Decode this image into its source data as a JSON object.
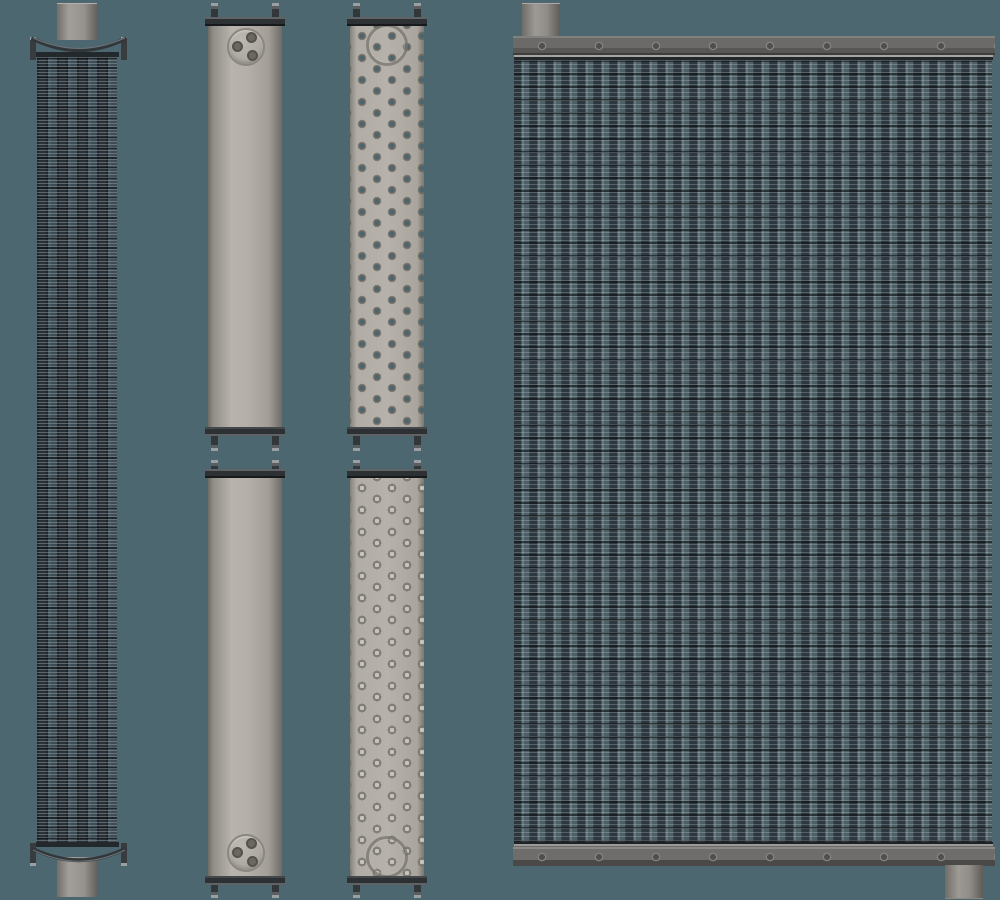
{
  "scene": {
    "background_color": "#4d6770",
    "parts": [
      {
        "id": "core-side-view",
        "label": "radiator core side view with end caps and pipe stubs"
      },
      {
        "id": "upper-tank",
        "label": "upper header tank with three-hole boss"
      },
      {
        "id": "upper-header-plate",
        "label": "upper header plate with staggered tube holes"
      },
      {
        "id": "lower-tank",
        "label": "lower header tank with three-hole boss"
      },
      {
        "id": "lower-header-plate",
        "label": "lower header plate with staggered tube holes"
      },
      {
        "id": "radiator-assembly",
        "label": "assembled radiator core with top and bottom headers and pipes"
      }
    ]
  },
  "colors": {
    "background": "#4d6770",
    "tank_light_gray": "#b3afa8",
    "flange_dark": "#2e3134",
    "core_blue_gray": "#4e5f68",
    "core_dark": "#2c373e",
    "header_gray": "#6b6a68",
    "pipe_gray": "#9d9a95",
    "hole_teal": "#4b656f"
  }
}
